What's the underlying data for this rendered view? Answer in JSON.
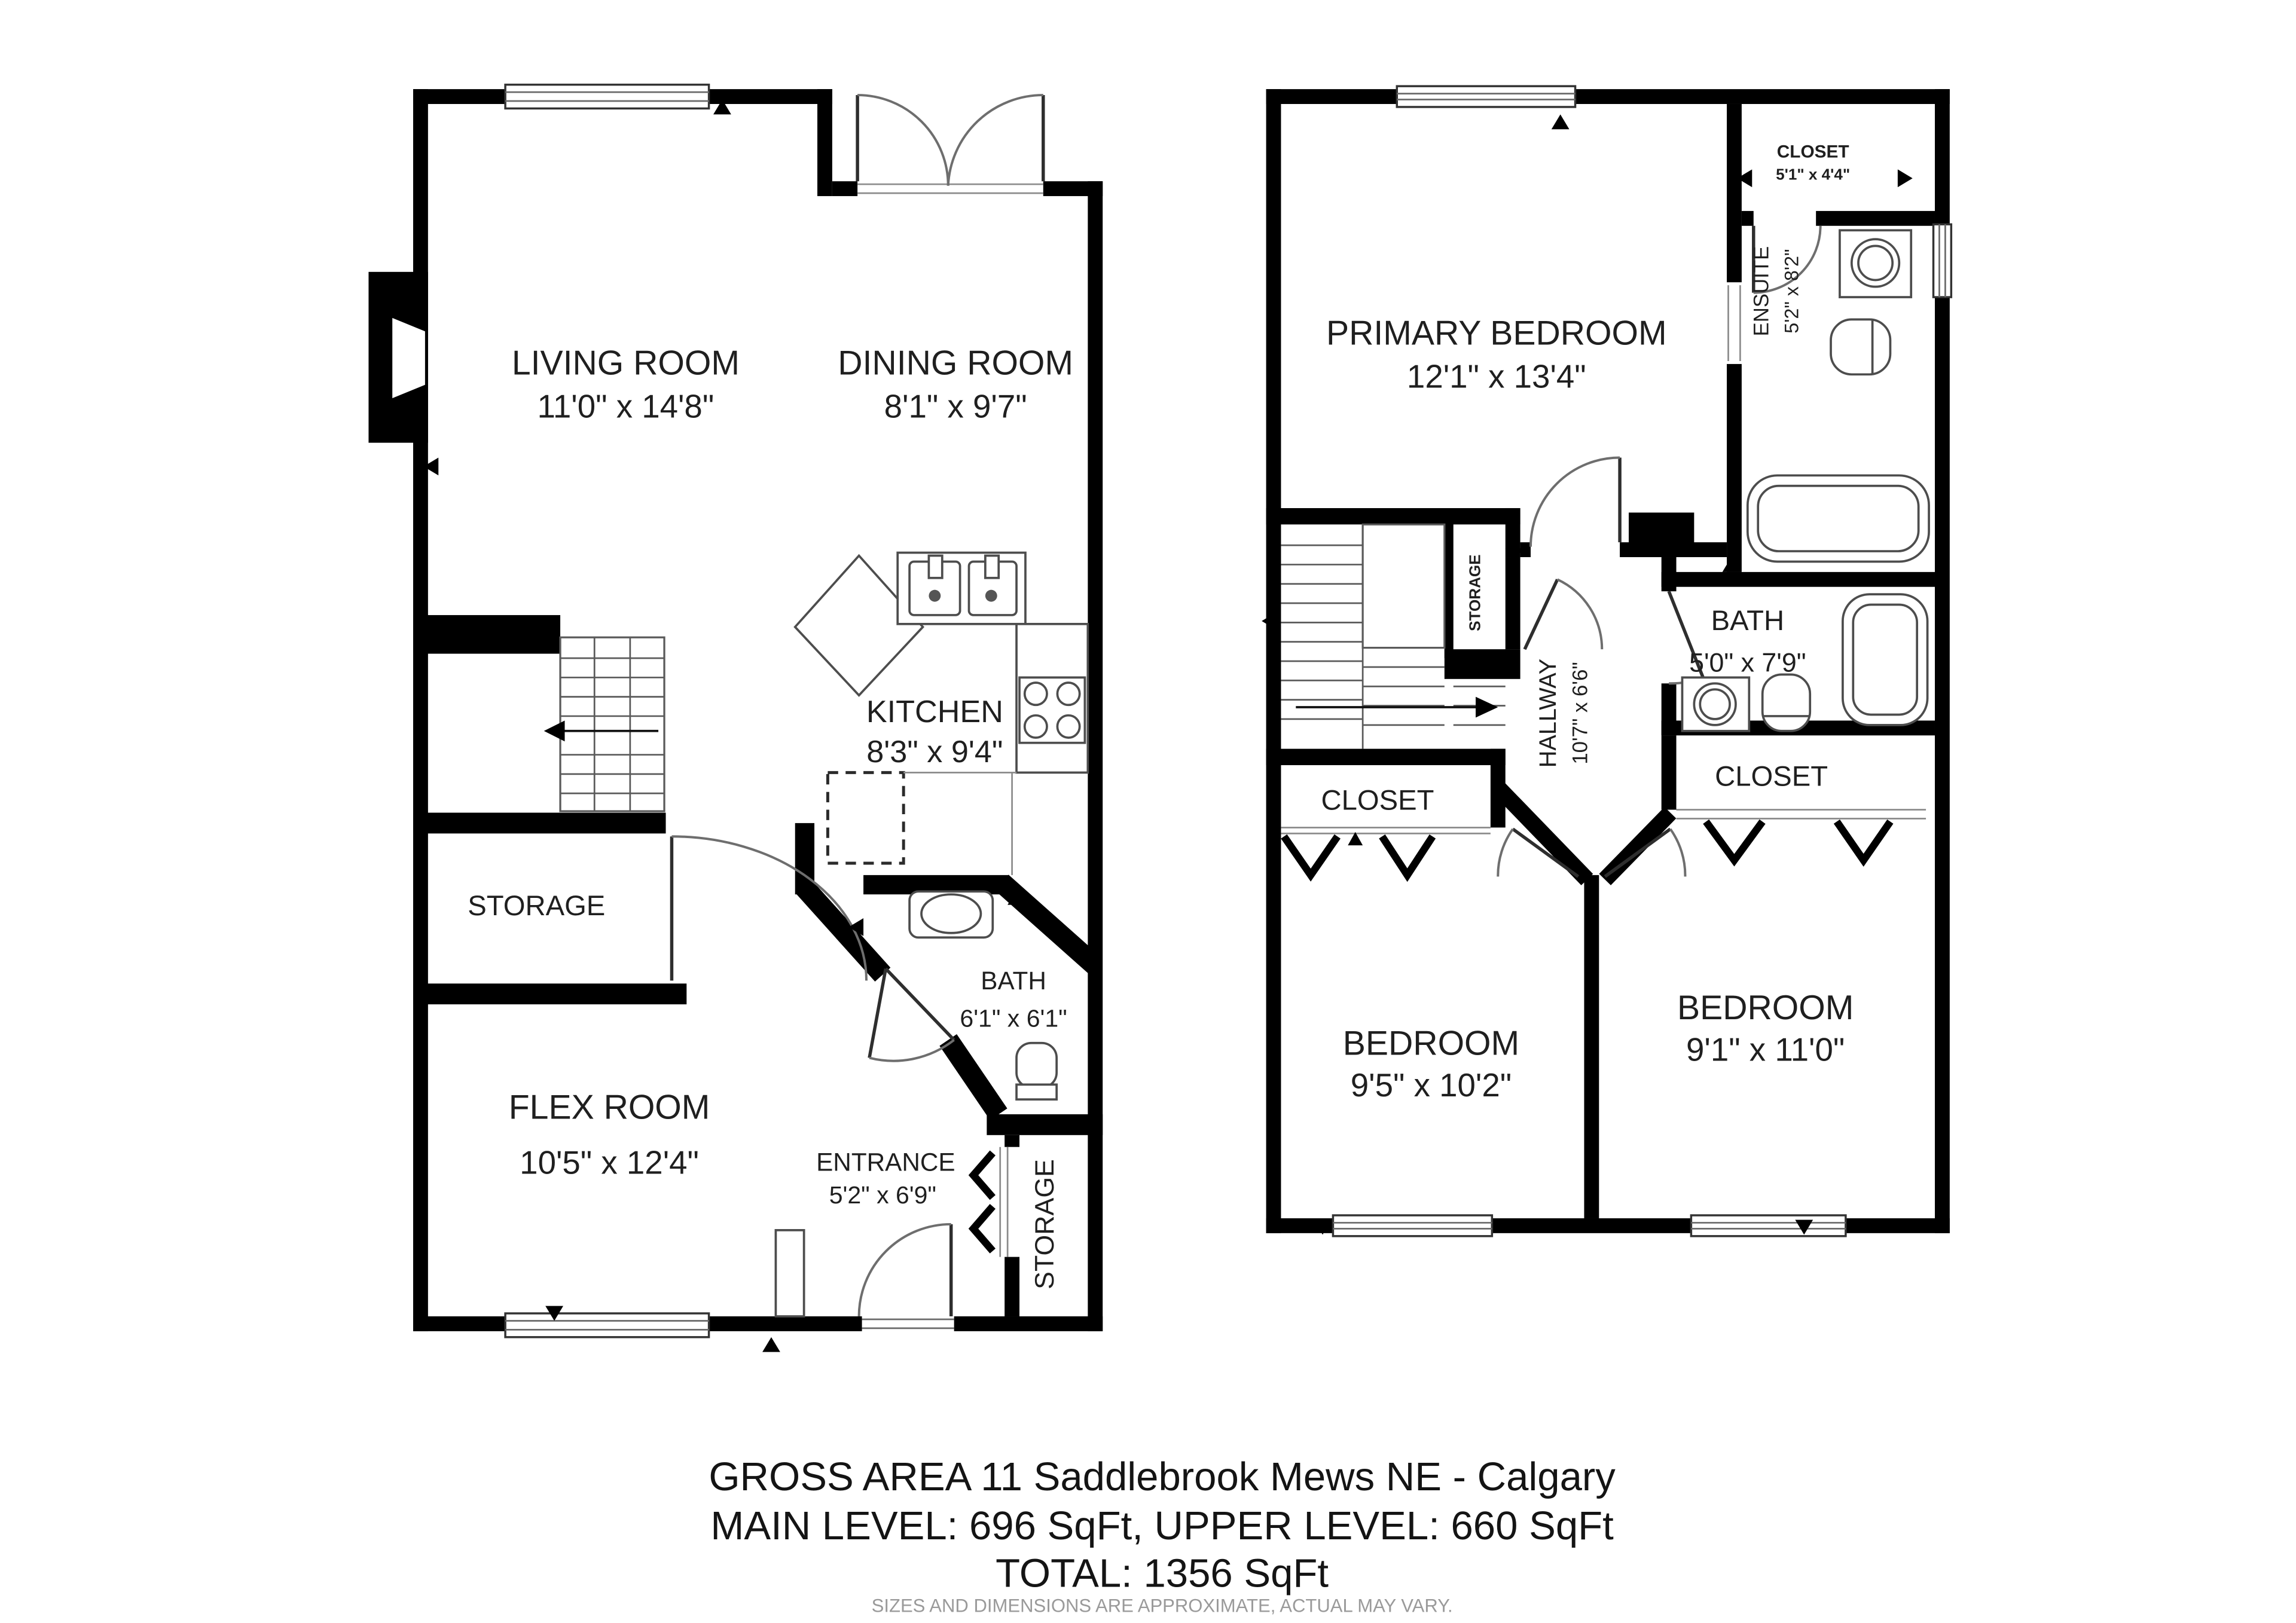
{
  "document_type": "floor-plan",
  "footer": {
    "line1": "GROSS AREA 11 Saddlebrook Mews NE - Calgary",
    "line2": "MAIN LEVEL: 696 SqFt, UPPER LEVEL: 660 SqFt",
    "line3": "TOTAL: 1356 SqFt",
    "disclaimer": "SIZES AND DIMENSIONS ARE APPROXIMATE, ACTUAL MAY VARY."
  },
  "main_level": {
    "living_room": {
      "name": "LIVING ROOM",
      "dims": "11'0\" x 14'8\""
    },
    "dining_room": {
      "name": "DINING ROOM",
      "dims": "8'1\" x 9'7\""
    },
    "kitchen": {
      "name": "KITCHEN",
      "dims": "8'3\" x 9'4\""
    },
    "storage": {
      "name": "STORAGE"
    },
    "flex_room": {
      "name": "FLEX ROOM",
      "dims": "10'5\" x 12'4\""
    },
    "bath": {
      "name": "BATH",
      "dims": "6'1\" x 6'1\""
    },
    "entrance": {
      "name": "ENTRANCE",
      "dims": "5'2\" x 6'9\""
    },
    "storage_rear": {
      "name": "STORAGE"
    }
  },
  "upper_level": {
    "primary_bedroom": {
      "name": "PRIMARY BEDROOM",
      "dims": "12'1\" x 13'4\""
    },
    "closet_top": {
      "name": "CLOSET",
      "dims": "5'1\" x 4'4\""
    },
    "ensuite": {
      "name": "ENSUITE",
      "dims": "5'2\" x 8'2\""
    },
    "bath": {
      "name": "BATH",
      "dims": "5'0\" x 7'9\""
    },
    "hallway": {
      "name": "HALLWAY",
      "dims": "10'7\" x 6'6\""
    },
    "storage": {
      "name": "STORAGE"
    },
    "closet_left": {
      "name": "CLOSET"
    },
    "closet_right": {
      "name": "CLOSET"
    },
    "bedroom_left": {
      "name": "BEDROOM",
      "dims": "9'5\" x 10'2\""
    },
    "bedroom_right": {
      "name": "BEDROOM",
      "dims": "9'1\" x 11'0\""
    }
  },
  "colors": {
    "walls": "#000000",
    "label_text": "#1f1f1f",
    "disclaimer_text": "#9a9a9a",
    "background": "#ffffff"
  }
}
